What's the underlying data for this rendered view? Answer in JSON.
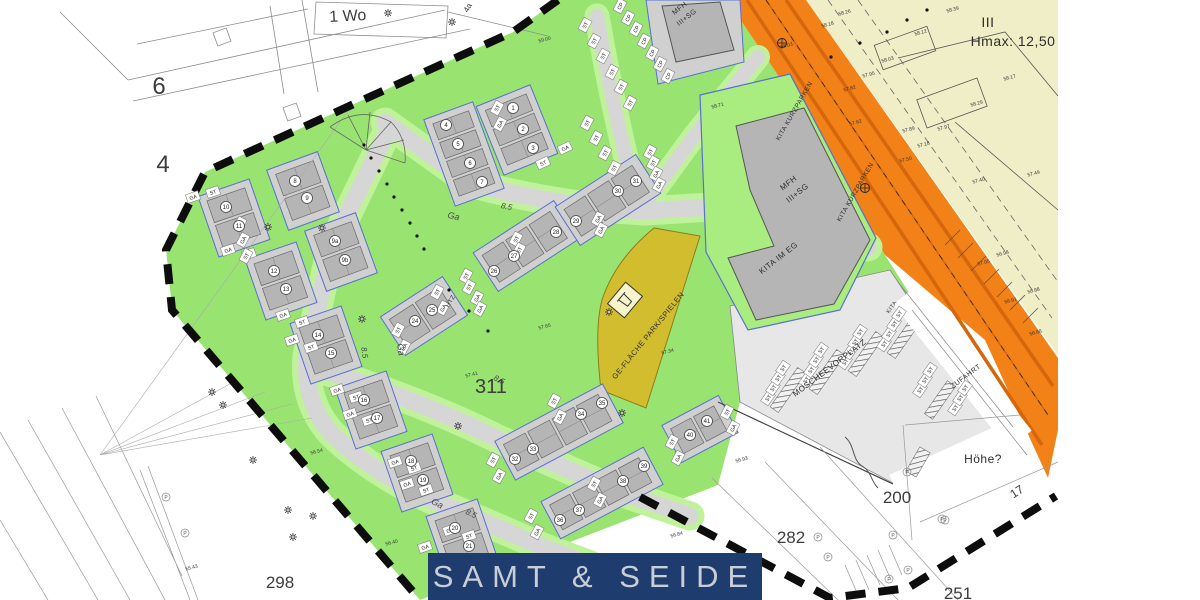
{
  "palette": {
    "estate_green": "#99e471",
    "verge_green": "#c0f29b",
    "pad_green": "#a9ec80",
    "road_gray": "#d6d6d6",
    "pad_gray": "#d0d0d0",
    "house_gray": "#b5b5b5",
    "parking_gray": "#e7e7e7",
    "orange": "#f28118",
    "orange_dark": "#d4660c",
    "khaki": "#f0eec6",
    "wedge_yellow": "#d2bd2f",
    "navy": "#1e3d6e",
    "banner_text": "#c9cdd5",
    "boundary": "#0d0d0d",
    "plot_blue": "#5a6fd0"
  },
  "banner": {
    "brand": "SAMT & SEIDE"
  },
  "labels": {
    "areas": [
      [
        "6",
        159,
        94,
        0,
        24
      ],
      [
        "4",
        163,
        172,
        0,
        24
      ],
      [
        "1 Wo",
        348,
        21,
        -3,
        16
      ],
      [
        "4a",
        470,
        9,
        -60,
        8
      ],
      [
        "311",
        491,
        393,
        0,
        20
      ],
      [
        "298",
        280,
        588,
        0,
        17
      ],
      [
        "282",
        791,
        543,
        0,
        17
      ],
      [
        "200",
        897,
        503,
        0,
        17
      ],
      [
        "251",
        958,
        599,
        0,
        17
      ],
      [
        "17",
        1019,
        495,
        -33,
        12
      ]
    ],
    "zones": [
      [
        "MFH",
        681,
        10,
        -38,
        7
      ],
      [
        "III+SG",
        688,
        19,
        -38,
        7
      ],
      [
        "MFH",
        790,
        185,
        -38,
        8
      ],
      [
        "III+SG",
        799,
        195,
        -38,
        8
      ],
      [
        "KITA IM EG",
        780,
        260,
        -38,
        8
      ],
      [
        "GE-FLÄCHE PARK/SPIELEN",
        650,
        337,
        -51,
        7.5
      ],
      [
        "MOSCHEEVORPLATZ",
        831,
        370,
        -37,
        8
      ],
      [
        "ZUFAHRT",
        967,
        378,
        -37,
        7
      ],
      [
        "KITA KURZPARKEN",
        796,
        112,
        -60,
        6.5
      ],
      [
        "KITA KURZPARKEN",
        857,
        193,
        -60,
        6.5
      ],
      [
        "III",
        988,
        27,
        0,
        14
      ],
      [
        "Hmax: 12,50",
        1013,
        46,
        0,
        14
      ],
      [
        "Höhe?",
        983,
        463,
        0,
        12
      ],
      [
        "HTZ",
        452,
        302,
        -60,
        6
      ],
      [
        "KITA",
        893,
        308,
        -55,
        5.5
      ]
    ],
    "streets": [
      [
        "8.5",
        506,
        209,
        12,
        8
      ],
      [
        "8.5",
        362,
        353,
        82,
        8
      ],
      [
        "8.5",
        498,
        382,
        27,
        8
      ],
      [
        "8.5",
        470,
        516,
        25,
        8
      ],
      [
        "Ga",
        453,
        219,
        12,
        9
      ],
      [
        "Ga",
        398,
        350,
        82,
        9
      ],
      [
        "Ga",
        436,
        506,
        27,
        9
      ]
    ],
    "plots": [
      [
        "1",
        513,
        108
      ],
      [
        "2",
        523,
        129
      ],
      [
        "3",
        533,
        148
      ],
      [
        "4",
        446,
        125
      ],
      [
        "5",
        458,
        144
      ],
      [
        "6",
        470,
        163
      ],
      [
        "7",
        482,
        182
      ],
      [
        "8",
        295,
        181
      ],
      [
        "9",
        307,
        198
      ],
      [
        "9a",
        335,
        241
      ],
      [
        "9b",
        345,
        260
      ],
      [
        "10",
        226,
        207
      ],
      [
        "11",
        239,
        226
      ],
      [
        "12",
        274,
        271
      ],
      [
        "13",
        286,
        289
      ],
      [
        "14",
        318,
        335
      ],
      [
        "15",
        331,
        353
      ],
      [
        "16",
        364,
        400
      ],
      [
        "17",
        377,
        418
      ],
      [
        "18",
        411,
        461
      ],
      [
        "19",
        423,
        480
      ],
      [
        "20",
        455,
        528
      ],
      [
        "21",
        469,
        546
      ],
      [
        "24",
        415,
        321
      ],
      [
        "25",
        432,
        310
      ],
      [
        "26",
        494,
        271
      ],
      [
        "27",
        514,
        256
      ],
      [
        "28",
        556,
        232
      ],
      [
        "29",
        576,
        221
      ],
      [
        "30",
        618,
        191
      ],
      [
        "31",
        636,
        181
      ],
      [
        "32",
        515,
        459
      ],
      [
        "33",
        533,
        449
      ],
      [
        "34",
        581,
        414
      ],
      [
        "35",
        602,
        403
      ],
      [
        "36",
        560,
        520
      ],
      [
        "37",
        579,
        510
      ],
      [
        "38",
        623,
        481
      ],
      [
        "39",
        644,
        466
      ],
      [
        "40",
        690,
        435
      ],
      [
        "41",
        707,
        421
      ]
    ],
    "stalls": [
      [
        "CP",
        620,
        6,
        -62
      ],
      [
        "CP",
        628,
        18,
        -62
      ],
      [
        "CP",
        636,
        29,
        -62
      ],
      [
        "CP",
        644,
        41,
        -62
      ],
      [
        "CP",
        652,
        53,
        -62
      ],
      [
        "CP",
        660,
        64,
        -62
      ],
      [
        "CP",
        668,
        76,
        -62
      ],
      [
        "ST",
        585,
        25,
        -62
      ],
      [
        "ST",
        594,
        41,
        -62
      ],
      [
        "ST",
        603,
        56,
        -62
      ],
      [
        "ST",
        612,
        72,
        -62
      ],
      [
        "ST",
        621,
        87,
        -62
      ],
      [
        "ST",
        630,
        103,
        -62
      ],
      [
        "ST",
        587,
        123,
        -62
      ],
      [
        "ST",
        596,
        138,
        -62
      ],
      [
        "ST",
        605,
        153,
        -62
      ],
      [
        "ST",
        614,
        168,
        -62
      ],
      [
        "ST",
        650,
        152,
        -62
      ],
      [
        "ST",
        653,
        163,
        -62
      ],
      [
        "GA",
        656,
        174,
        -62
      ],
      [
        "GA",
        659,
        185,
        -62
      ],
      [
        "GA",
        598,
        219,
        -62
      ],
      [
        "GA",
        601,
        230,
        -62
      ],
      [
        "ST",
        466,
        276,
        -62
      ],
      [
        "ST",
        469,
        287,
        -62
      ],
      [
        "GA",
        477,
        298,
        -62
      ],
      [
        "GA",
        480,
        309,
        -62
      ],
      [
        "ST",
        516,
        239,
        -62
      ],
      [
        "ST",
        519,
        250,
        -62
      ],
      [
        "ST",
        437,
        292,
        -62
      ],
      [
        "GA",
        443,
        308,
        -62
      ],
      [
        "ST",
        398,
        330,
        -62
      ],
      [
        "GA",
        404,
        347,
        -62
      ],
      [
        "GA",
        565,
        148,
        -25
      ],
      [
        "ST",
        543,
        163,
        -25
      ],
      [
        "ST",
        497,
        108,
        -62
      ],
      [
        "GA",
        500,
        124,
        -62
      ],
      [
        "GA",
        193,
        197,
        -19
      ],
      [
        "ST",
        213,
        192,
        -19
      ],
      [
        "GA",
        228,
        250,
        -19
      ],
      [
        "ST",
        249,
        254,
        -19
      ],
      [
        "GA",
        283,
        315,
        -19
      ],
      [
        "ST",
        302,
        322,
        -19
      ],
      [
        "GA",
        292,
        340,
        -19
      ],
      [
        "ST",
        311,
        347,
        -19
      ],
      [
        "GA",
        337,
        390,
        -19
      ],
      [
        "ST",
        356,
        397,
        -19
      ],
      [
        "GA",
        350,
        414,
        -19
      ],
      [
        "ST",
        369,
        420,
        -19
      ],
      [
        "GA",
        395,
        462,
        -19
      ],
      [
        "ST",
        414,
        468,
        -19
      ],
      [
        "GA",
        407,
        484,
        -19
      ],
      [
        "ST",
        426,
        490,
        -19
      ],
      [
        "GA",
        450,
        530,
        -19
      ],
      [
        "ST",
        469,
        536,
        -19
      ],
      [
        "GA",
        425,
        547,
        -19
      ],
      [
        "GA",
        240,
        224,
        -62
      ],
      [
        "GA",
        243,
        240,
        -62
      ],
      [
        "ST",
        246,
        256,
        -62
      ],
      [
        "ST",
        493,
        460,
        -62
      ],
      [
        "GA",
        499,
        476,
        -62
      ],
      [
        "GA",
        560,
        417,
        -62
      ],
      [
        "ST",
        554,
        401,
        -62
      ],
      [
        "ST",
        531,
        516,
        -62
      ],
      [
        "GA",
        537,
        532,
        -62
      ],
      [
        "ST",
        594,
        484,
        -62
      ],
      [
        "GA",
        600,
        500,
        -62
      ],
      [
        "ST",
        672,
        442,
        -62
      ],
      [
        "GA",
        678,
        458,
        -62
      ],
      [
        "ST",
        727,
        412,
        -62
      ],
      [
        "GA",
        733,
        428,
        -62
      ],
      [
        "ST",
        768,
        398,
        -55
      ],
      [
        "ST",
        773,
        388,
        -55
      ],
      [
        "ST",
        778,
        378,
        -55
      ],
      [
        "ST",
        783,
        368,
        -55
      ],
      [
        "ST",
        806,
        380,
        -55
      ],
      [
        "ST",
        811,
        370,
        -55
      ],
      [
        "ST",
        816,
        360,
        -55
      ],
      [
        "ST",
        821,
        350,
        -55
      ],
      [
        "ST",
        845,
        362,
        -55
      ],
      [
        "ST",
        850,
        352,
        -55
      ],
      [
        "ST",
        855,
        342,
        -55
      ],
      [
        "ST",
        860,
        332,
        -55
      ],
      [
        "ST",
        884,
        344,
        -55
      ],
      [
        "ST",
        889,
        334,
        -55
      ],
      [
        "ST",
        894,
        324,
        -55
      ],
      [
        "ST",
        899,
        314,
        -55
      ],
      [
        "ST",
        920,
        390,
        -55
      ],
      [
        "ST",
        925,
        380,
        -55
      ],
      [
        "ST",
        930,
        370,
        -55
      ],
      [
        "ST",
        955,
        408,
        -55
      ],
      [
        "ST",
        960,
        398,
        -55
      ],
      [
        "ST",
        965,
        388,
        -55
      ]
    ],
    "elevations": [
      [
        "58.39",
        953,
        11
      ],
      [
        "58.26",
        845,
        14
      ],
      [
        "58.18",
        828,
        26
      ],
      [
        "58.12",
        921,
        34
      ],
      [
        "58.03",
        888,
        61
      ],
      [
        "57.95",
        869,
        76
      ],
      [
        "57.82",
        850,
        90
      ],
      [
        "57.62",
        856,
        124
      ],
      [
        "58.17",
        1010,
        79
      ],
      [
        "58.29",
        977,
        105
      ],
      [
        "57.89",
        909,
        131
      ],
      [
        "57.97",
        944,
        129
      ],
      [
        "57.18",
        924,
        146
      ],
      [
        "57.50",
        906,
        161
      ],
      [
        "57.49",
        1034,
        175
      ],
      [
        "57.40",
        979,
        182
      ],
      [
        "57.05",
        984,
        264
      ],
      [
        "56.98",
        1003,
        255
      ],
      [
        "56.88",
        1034,
        292
      ],
      [
        "56.91",
        1011,
        302
      ],
      [
        "56.68",
        1036,
        334
      ],
      [
        "58.71",
        718,
        107
      ],
      [
        "59.00",
        545,
        41
      ],
      [
        "58.03",
        787,
        47
      ],
      [
        "57.65",
        545,
        328
      ],
      [
        "57.41",
        472,
        376
      ],
      [
        "57.34",
        668,
        353
      ],
      [
        "56.84",
        677,
        536
      ],
      [
        "56.93",
        742,
        461
      ],
      [
        "56.54",
        317,
        453
      ],
      [
        "56.40",
        392,
        544
      ],
      [
        "55.43",
        192,
        569
      ]
    ]
  },
  "symbols": {
    "trees": [
      [
        268,
        227
      ],
      [
        322,
        228
      ],
      [
        362,
        319
      ],
      [
        458,
        426
      ],
      [
        609,
        312
      ],
      [
        622,
        413
      ],
      [
        212,
        392
      ],
      [
        223,
        405
      ],
      [
        253,
        460
      ],
      [
        288,
        510
      ],
      [
        313,
        516
      ],
      [
        293,
        537
      ],
      [
        388,
        13
      ],
      [
        452,
        22
      ]
    ],
    "dots": [
      [
        364,
        145
      ],
      [
        371,
        158
      ],
      [
        379,
        171
      ],
      [
        387,
        184
      ],
      [
        394,
        197
      ],
      [
        402,
        210
      ],
      [
        410,
        223
      ],
      [
        417,
        236
      ],
      [
        424,
        249
      ],
      [
        449,
        290
      ],
      [
        469,
        311
      ],
      [
        488,
        331
      ],
      [
        831,
        57
      ],
      [
        860,
        43
      ],
      [
        887,
        32
      ],
      [
        907,
        20
      ],
      [
        927,
        10
      ]
    ],
    "p_marks": [
      [
        166,
        497
      ],
      [
        185,
        533
      ],
      [
        818,
        537
      ],
      [
        828,
        557
      ],
      [
        893,
        535
      ],
      [
        945,
        520
      ],
      [
        908,
        570
      ],
      [
        889,
        579
      ],
      [
        942,
        519
      ],
      [
        907,
        472
      ]
    ],
    "survey_marks": [
      [
        782,
        43
      ],
      [
        865,
        188
      ]
    ]
  }
}
